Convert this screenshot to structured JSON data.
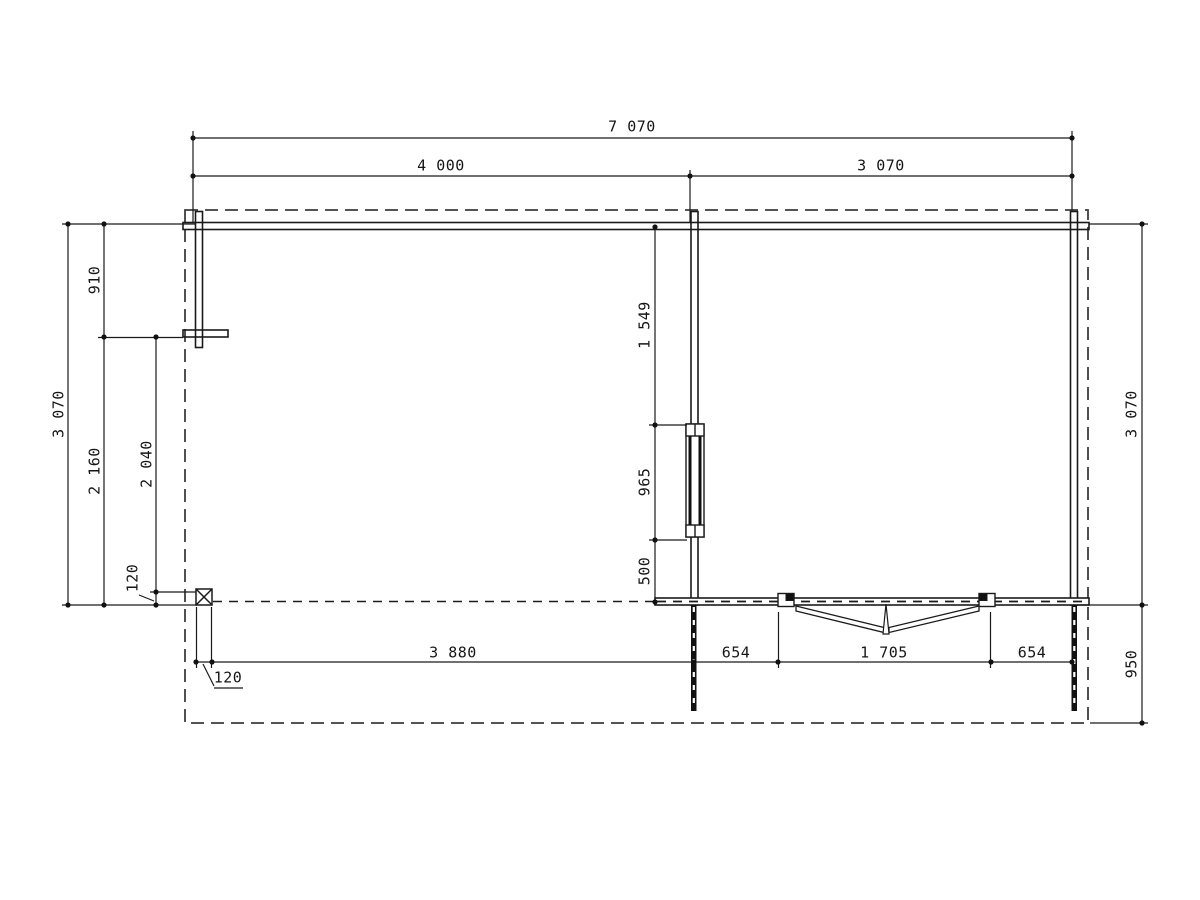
{
  "drawing": {
    "type": "floor-plan",
    "colors": {
      "line": "#1a1a1a",
      "roof_dash": "#3d3d3d",
      "background": "#ffffff"
    },
    "dims": {
      "top_total": "7 070",
      "top_left_bay": "4 000",
      "top_right_bay": "3 070",
      "left_total": "3 070",
      "left_upper": "910",
      "left_lower": "2 160",
      "left_inner": "2 040",
      "left_post_size": "120",
      "mid_above_window": "1 549",
      "mid_window": "965",
      "mid_below_window": "500",
      "right_depth": "3 070",
      "right_porch": "950",
      "bottom_post_size": "120",
      "bottom_left_bay": "3 880",
      "bottom_left_of_door": "654",
      "bottom_door_width": "1 705",
      "bottom_right_of_door": "654"
    }
  }
}
